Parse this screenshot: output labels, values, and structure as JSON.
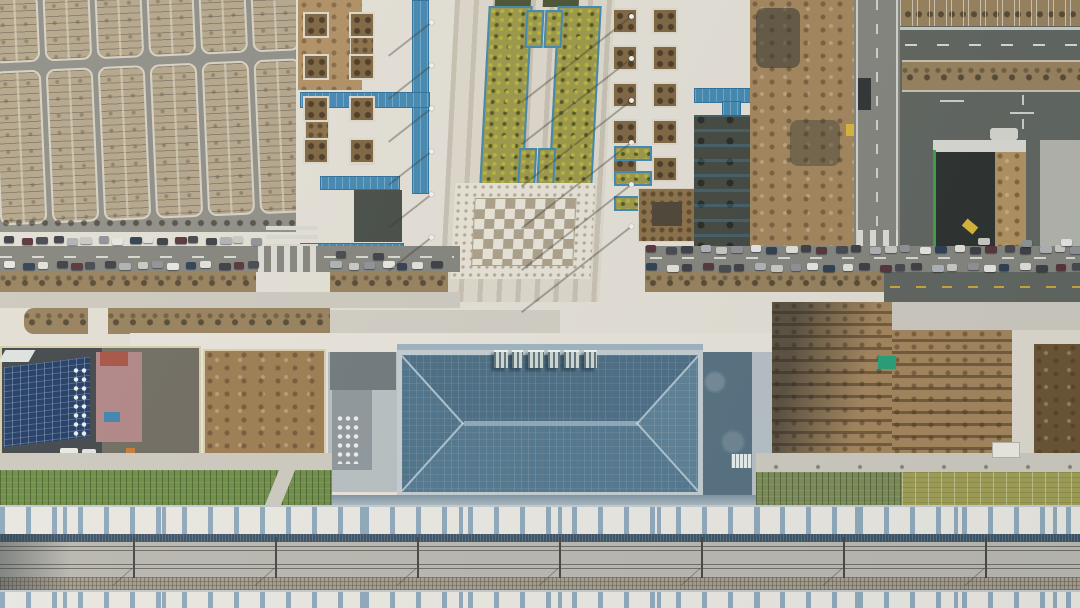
{
  "scene": {
    "setting": "aerial-drone-view-railway-station-construction-site",
    "areas": [
      "parking-lot",
      "access-road",
      "station-plaza",
      "construction-zone",
      "station-building",
      "solar-compound",
      "excavation-pit",
      "platform-canopies",
      "railway-tracks",
      "landscaping-strips"
    ]
  },
  "palette": {
    "asphalt": "#8e8e87",
    "roadGray": "#84847d",
    "roadDark": "#5f645e",
    "paleRoad": "#cdc9bf",
    "stall": "#b3a58a",
    "islandEdge": "#d6d1c3",
    "plaza": "#e3dfd5",
    "plazaBright": "#eae6dd",
    "forecourt": "#e7e3da",
    "stripeDark": "#c7c0b1",
    "stripeLight": "#ddd7ca",
    "mosaicBg": "#e6e1d5",
    "mosaicDot": "#b3a890",
    "checkDark": "#ab9f88",
    "checkLight": "#e8e3d7",
    "veg": "#9b9747",
    "vegDot": "#50531f",
    "darkbed": "#4a5232",
    "bluePlate": "#4187b0",
    "bluePlate2": "#2f6f99",
    "dirt": "#a3855c",
    "dirtDark": "#6b5334",
    "hedge": "#97805c",
    "darkexc": "#42473f",
    "roofTop": "#4a6c83",
    "roofBottom": "#53778e",
    "roofLeft": "#4e7289",
    "roofRight": "#5d8095",
    "roofRidge": "#8ea9b8",
    "roofFrame": "#c2cdd2",
    "facade": "#9db3bf",
    "annexL": "#b7bfc2",
    "annexLdark": "#6f787b",
    "annexR": "#56707f",
    "wallLight": "#b6c0c4",
    "solar": "#223a62",
    "pinkBld": "#b08585",
    "redBld": "#a85243",
    "tarpBlue": "#3f83ad",
    "tarpGreen": "#27a077",
    "canopy": "#eae8e1",
    "rib": "#8fa9bb",
    "canopyEdge": "#45617a",
    "trackbed": "#bab8b0",
    "rail": "#6e6e67",
    "ballast": "#a59d8d",
    "meshDark": "#3c5366",
    "greenL": "#6d8c44",
    "greenGray": "#7c8b55",
    "greenY": "#9f9f55",
    "yellowLine": "#c9a53a",
    "fenceGreen": "#3ba045",
    "cream": "#e9dec0",
    "excavYellow": "#d8b43a",
    "pitDark": "#2b302d",
    "pitSlope": "#b2925f",
    "compoundDark": "#41464a",
    "compoundGray": "#6f6b60"
  },
  "car_colors": [
    "#3a3e44",
    "#e6e6e2",
    "#aeb2b6",
    "#56333a",
    "#2e3e52",
    "#c9c9c4",
    "#44484e",
    "#e2e0da",
    "#8e9296",
    "#3c3f45"
  ],
  "generate": {
    "parking_bands": [
      {
        "x": -4,
        "y": -12,
        "h": 64,
        "n": 7,
        "pitch": 52,
        "w": 43
      },
      {
        "x": -4,
        "y": 64,
        "h": 150,
        "n": 7,
        "pitch": 52,
        "w": 43
      }
    ],
    "car_rows": [
      {
        "y": 237,
        "x0": 6,
        "x1": 250,
        "n": 17
      },
      {
        "y": 262,
        "x0": 6,
        "x1": 250,
        "n": 16
      },
      {
        "y": 262,
        "x0": 332,
        "x1": 430,
        "n": 7
      },
      {
        "y": 246,
        "x0": 648,
        "x1": 1072,
        "n": 26
      },
      {
        "y": 264,
        "x0": 648,
        "x1": 1072,
        "n": 25
      },
      {
        "y": 239,
        "x0": 980,
        "x1": 1062,
        "n": 3
      },
      {
        "y": 252,
        "x0": 338,
        "x1": 372,
        "n": 2
      }
    ],
    "lamp_columns": [
      {
        "x": 431,
        "y0": 22,
        "pitch": 43,
        "n": 6,
        "shadow": 55
      },
      {
        "x": 631,
        "y0": 16,
        "pitch": 42,
        "n": 6,
        "shadow": 140
      }
    ],
    "tree_grids": [
      {
        "x0": 612,
        "y0": 8,
        "cols": 2,
        "rows": 5,
        "px": 40,
        "py": 37
      },
      {
        "x0": 303,
        "y0": 12,
        "cols": 2,
        "rows": 4,
        "px": 46,
        "py": 42
      }
    ],
    "catenary": {
      "x0": -9,
      "pitch": 142,
      "n": 8,
      "y": 537,
      "h": 41
    },
    "sign_blocks": {
      "y": 350,
      "h": 16,
      "xs": [
        494,
        512,
        528,
        548,
        564,
        584
      ],
      "ws": [
        14,
        11,
        16,
        12,
        15,
        13
      ]
    }
  }
}
